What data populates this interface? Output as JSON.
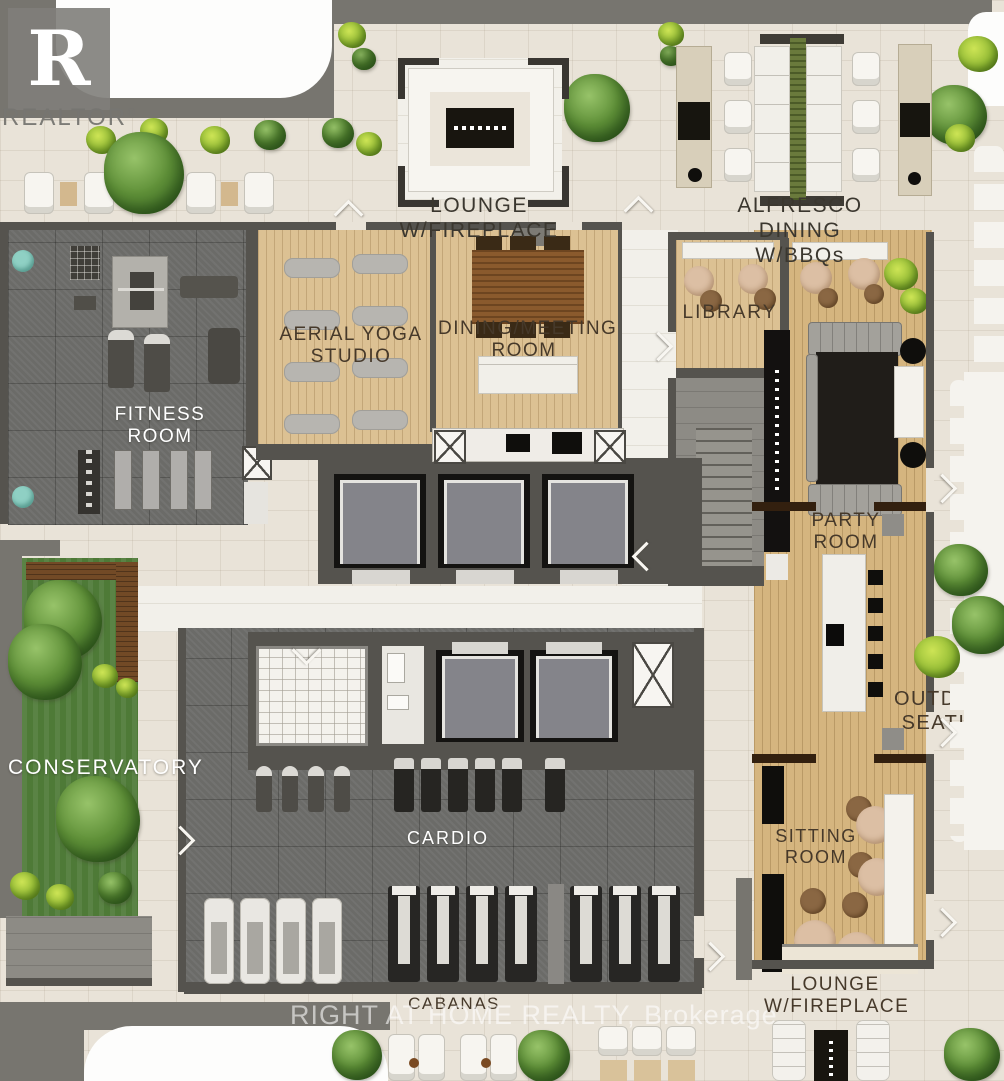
{
  "plan": {
    "labels": {
      "lounge_top": "LOUNGE\nW/FIREPLACE",
      "alfresco": "ALFRESCO DINING\nW/BBQs",
      "yoga": "AERIAL YOGA\nSTUDIO",
      "dining": "DINING/MEETING\nROOM",
      "library": "LIBRARY",
      "fitness": "FITNESS\nROOM",
      "party": "PARTY\nROOM",
      "conservatory": "CONSERVATORY",
      "outdoor": "OUTDOOR\nSEATING",
      "cardio": "CARDIO",
      "sitting": "SITTING\nROOM",
      "cabanas": "CABANAS",
      "lounge_bottom": "LOUNGE\nW/FIREPLACE"
    },
    "branding": {
      "logo_letter": "R",
      "logo_name": "REALTOR",
      "registered_mark": "®",
      "watermark": "RIGHT AT HOME REALTY, Brokerage"
    },
    "colors": {
      "tile": "#e9e3d8",
      "wall": "#77756f",
      "wall_dark": "#55534e",
      "wood": "#dcc193",
      "wood_party": "#d5b57f",
      "gym_floor": "#6b6b68",
      "grass": "#4e7a37",
      "marble": "#f2f0ea",
      "label_dark": "#46392a",
      "label_light": "#ffffff"
    }
  }
}
